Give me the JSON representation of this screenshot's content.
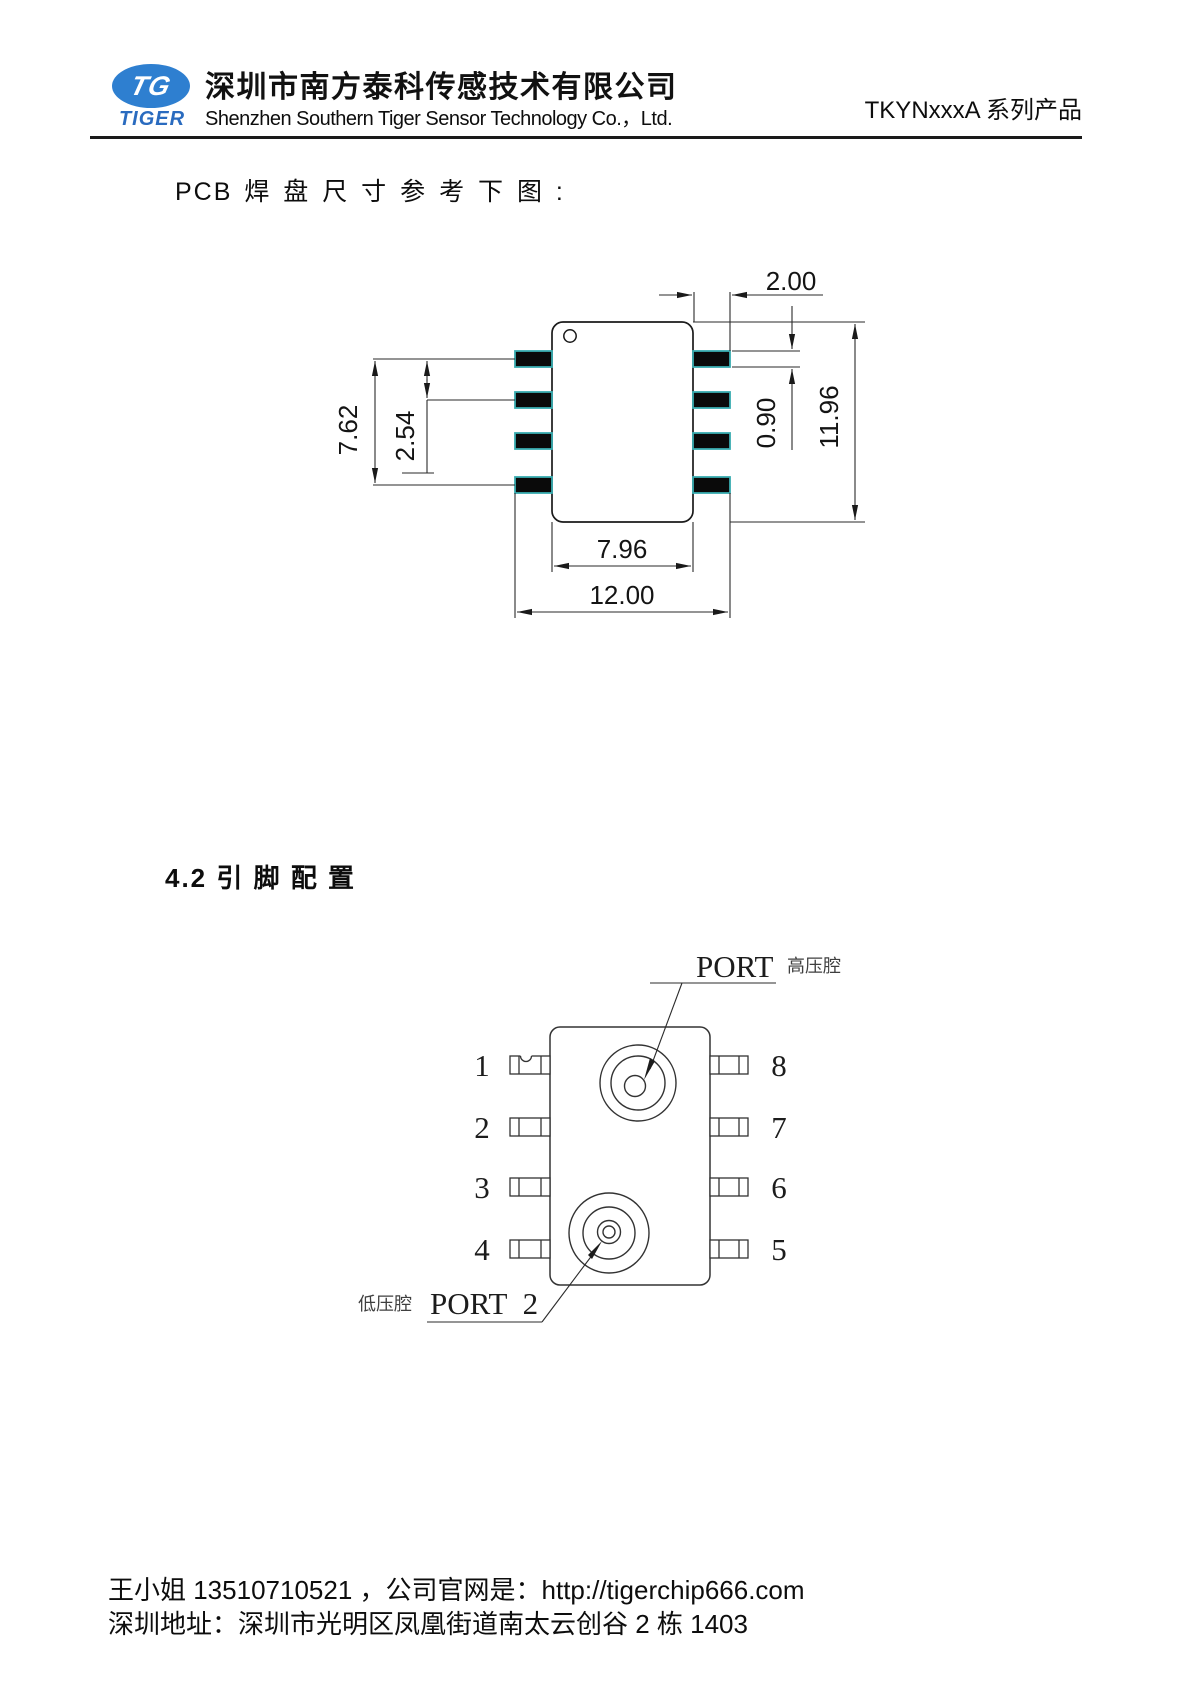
{
  "header": {
    "logo_monogram": "TG",
    "logo_word": "TIGER",
    "company_cn": "深圳市南方泰科传感技术有限公司",
    "company_en": "Shenzhen Southern Tiger Sensor Technology Co.，Ltd.",
    "product_series": "TKYNxxxA 系列产品"
  },
  "body_text": {
    "pcb_note": "PCB 焊 盘 尺 寸 参 考 下 图 :",
    "section_title": "4.2  引 脚 配 置"
  },
  "pcb_drawing": {
    "dims": {
      "pad_width": "2.00",
      "pad_height": "0.90",
      "overall_height": "11.96",
      "pad_row_span": "7.62",
      "pad_pitch": "2.54",
      "body_width": "7.96",
      "overall_width": "12.00"
    }
  },
  "pin_diagram": {
    "left_pins": [
      "1",
      "2",
      "3",
      "4"
    ],
    "right_pins": [
      "8",
      "7",
      "6",
      "5"
    ],
    "port1_label": "PORT",
    "port1_note": "高压腔",
    "port2_label": "PORT 2",
    "port2_note": "低压腔"
  },
  "footer": {
    "line1": "王小姐 13510710521 ，公司官网是：http://tigerchip666.com",
    "line2": "深圳地址：深圳市光明区凤凰街道南太云创谷 2 栋 1403"
  }
}
